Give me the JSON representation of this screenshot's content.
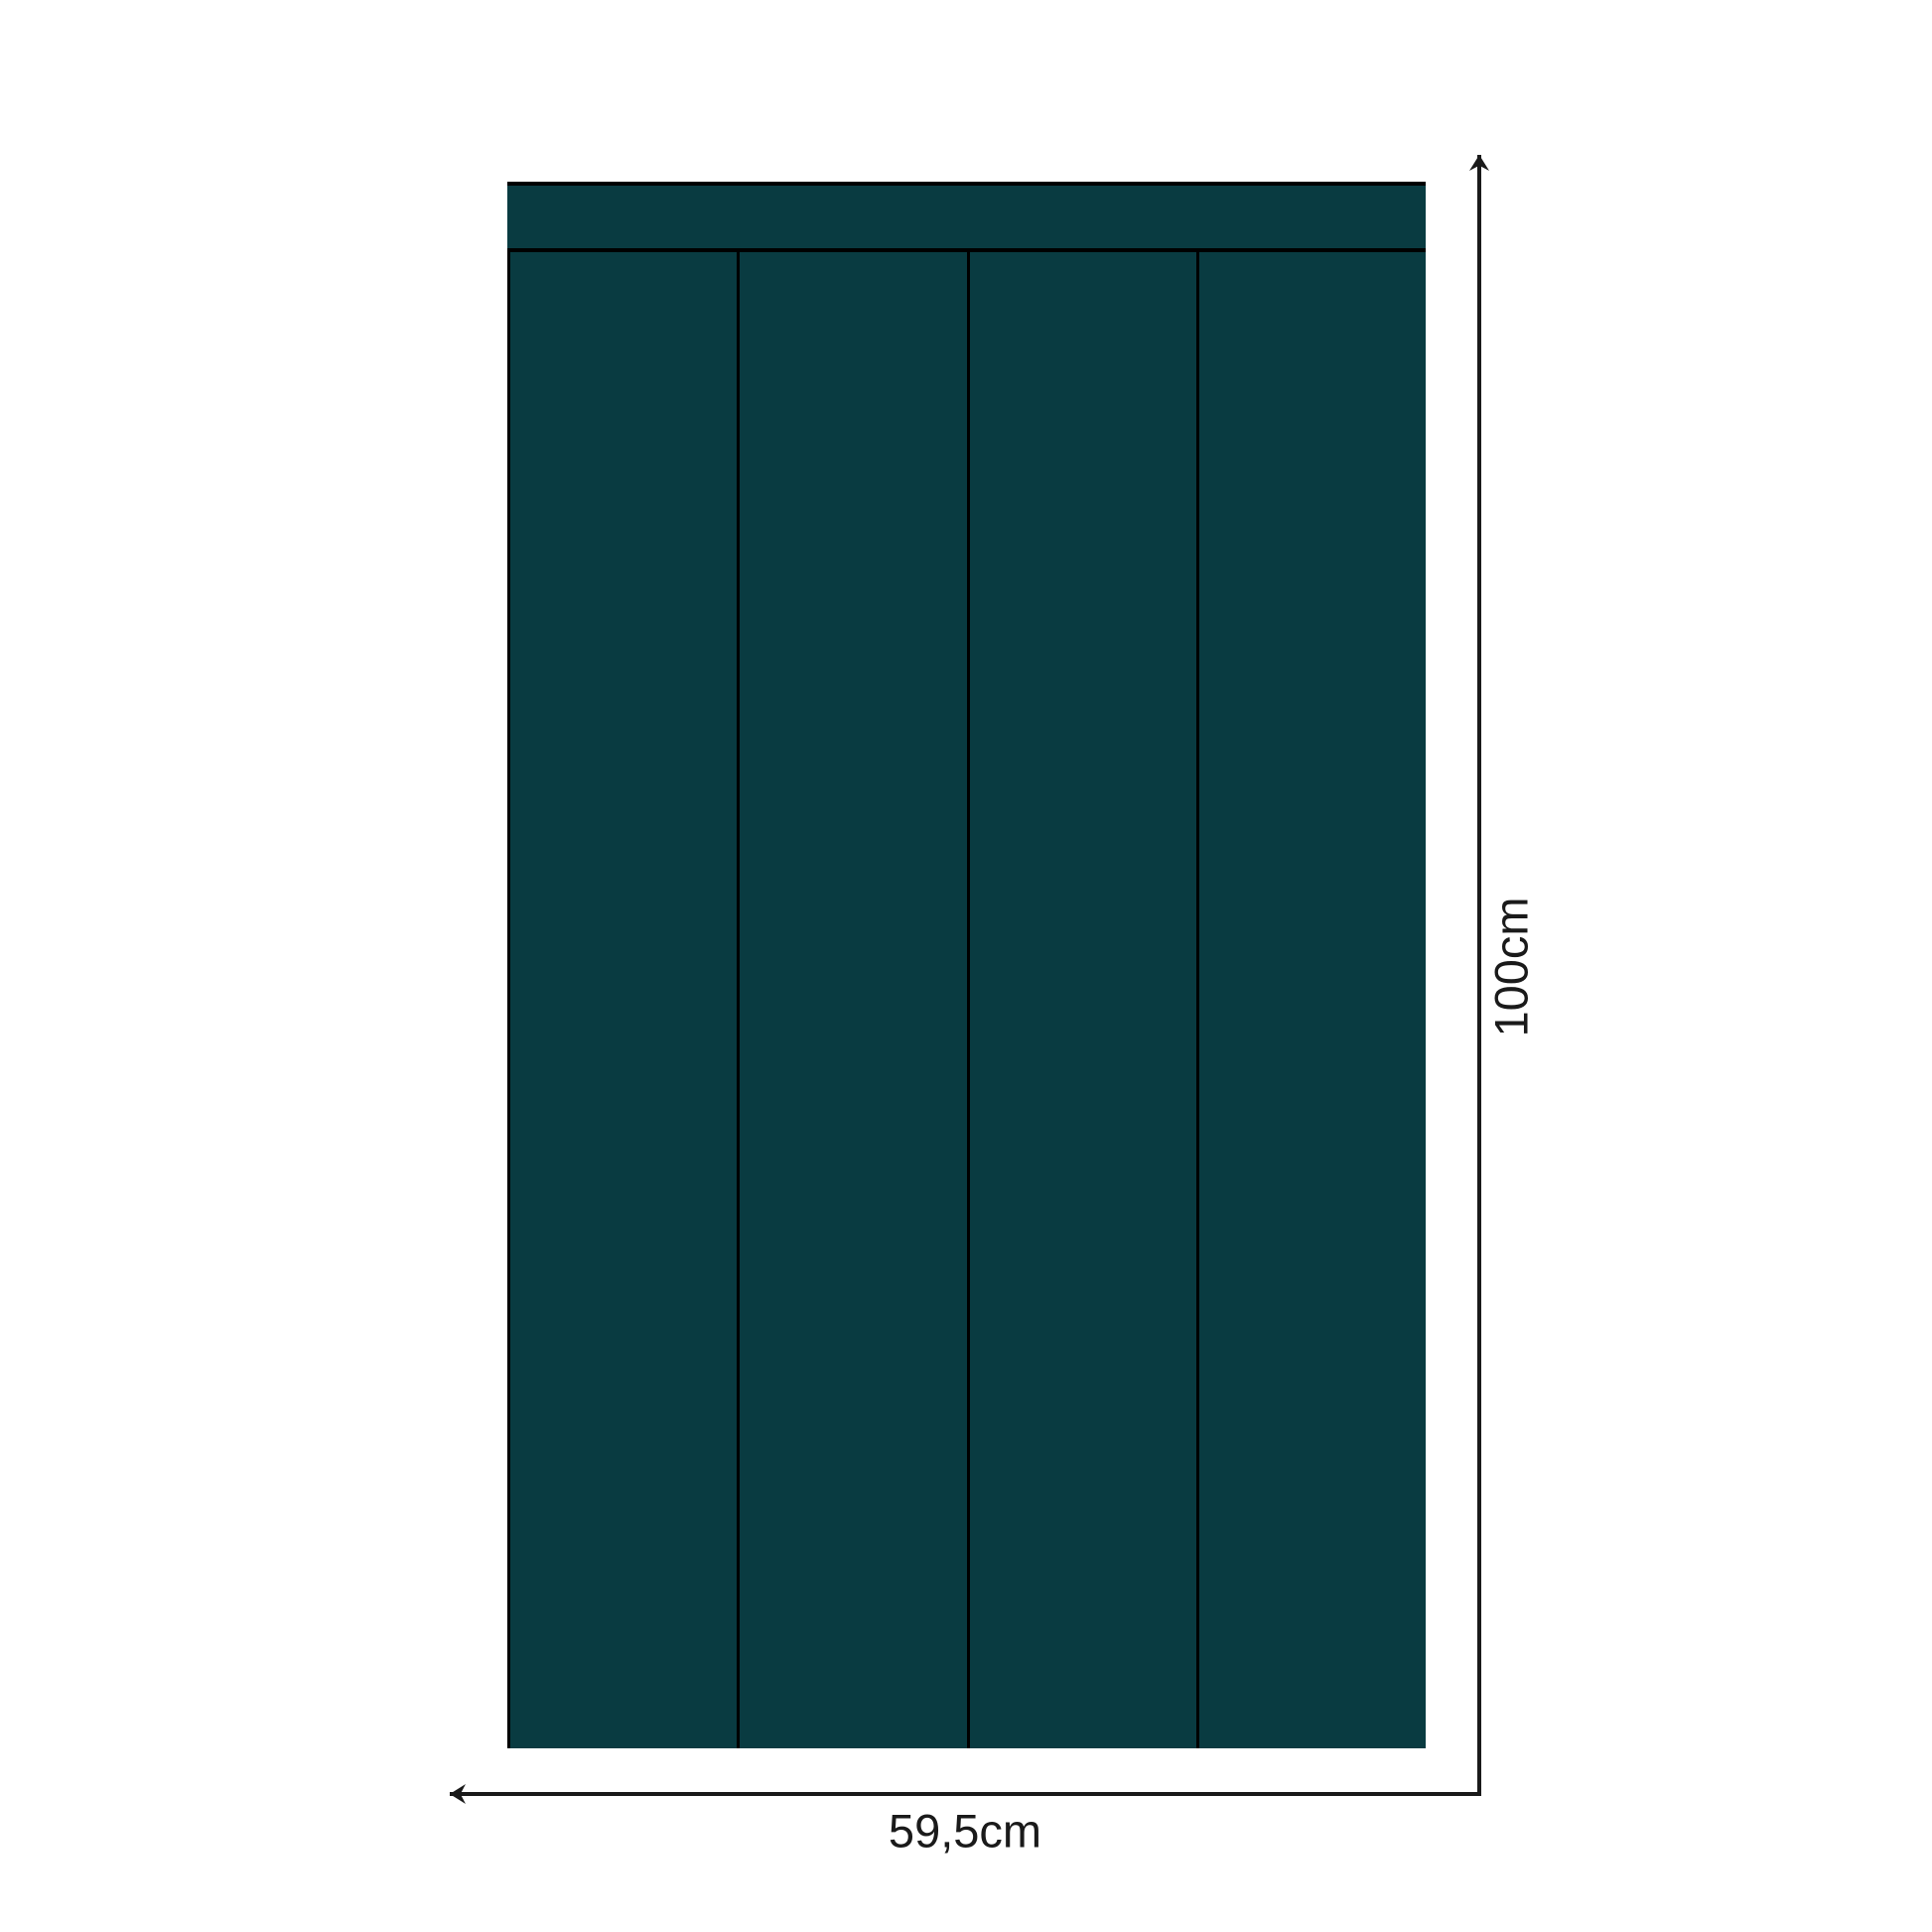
{
  "diagram": {
    "type": "dimension-drawing",
    "subject": "wall-panel-set",
    "panel_count": 4,
    "width_label": "59,5cm",
    "height_label": "100cm"
  },
  "colors": {
    "panel_fill": "#093b41",
    "outline": "#000000",
    "dimension_line": "#1a1a1a",
    "label_text": "#1a1a1a",
    "background": "#ffffff"
  }
}
